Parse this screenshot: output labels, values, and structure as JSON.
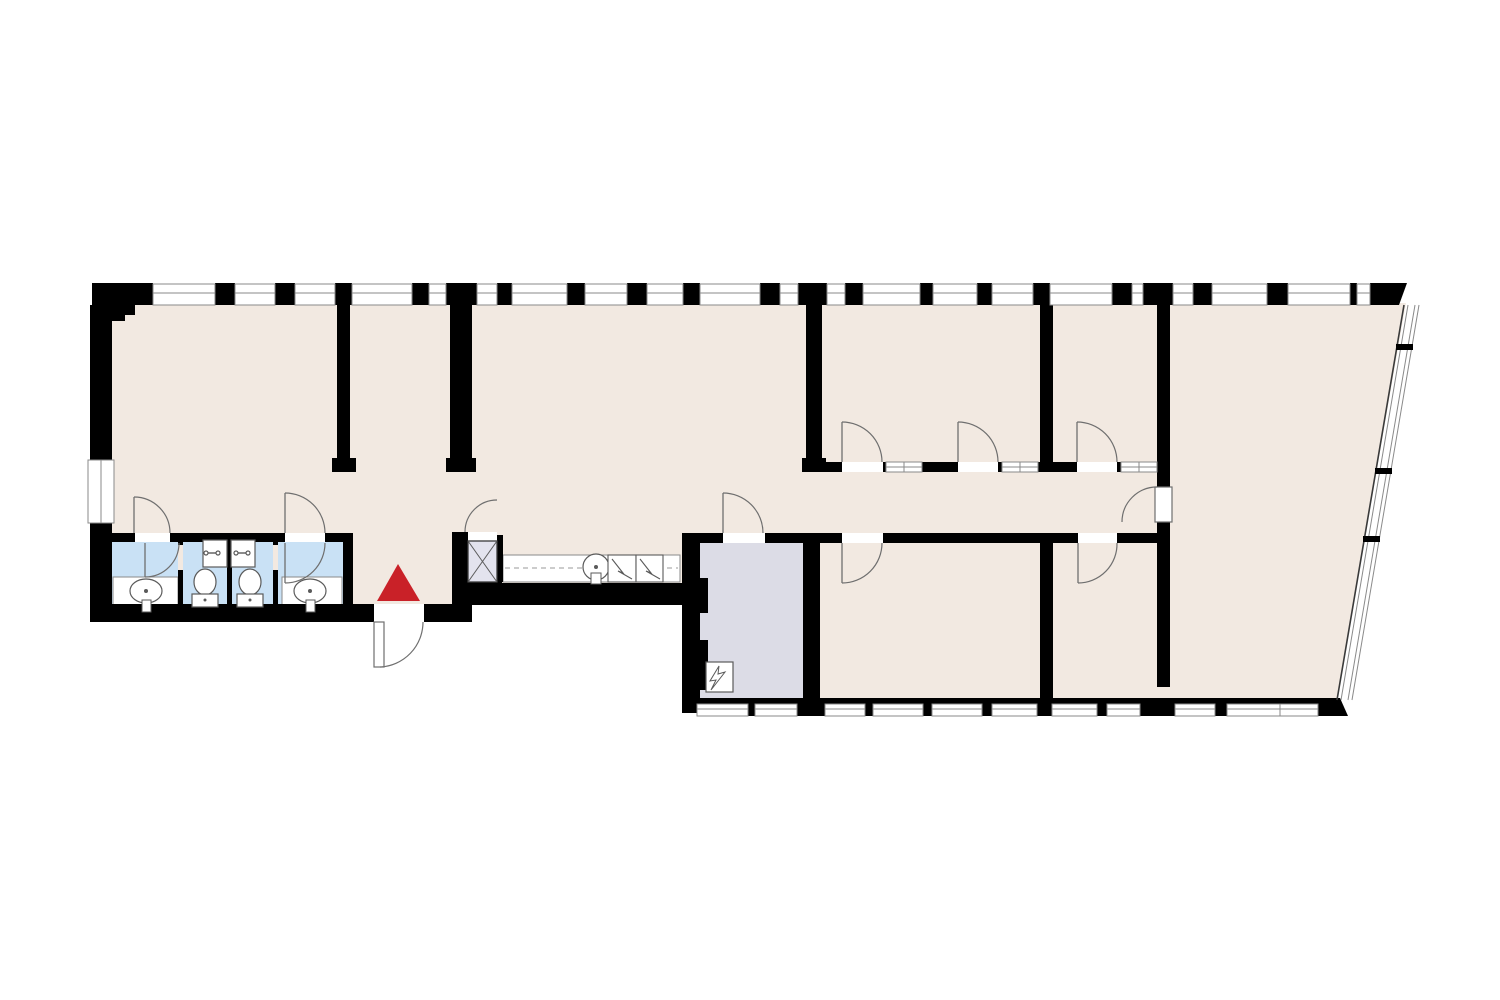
{
  "document": {
    "kind": "architectural-floor-plan",
    "visible_text": []
  },
  "canvas": {
    "width": 1500,
    "height": 1000,
    "background": "#ffffff"
  },
  "palette": {
    "floor": "#f2e9e1",
    "wall": "#000000",
    "bathroom": "#c9e1f5",
    "technical_room": "#dcdce6",
    "elevator_car": "#e3e3ee",
    "entrance_marker_red": "#c92128",
    "door_line": "#6f6f6f",
    "frame_line": "#8a8a8a",
    "fixture_line": "#5a5a5a",
    "dash_line": "#9a9a9a",
    "step_line": "#b5b5b5",
    "white": "#ffffff"
  },
  "plan": {
    "floor_polygon": [
      [
        92,
        303
      ],
      [
        1406,
        303
      ],
      [
        1336,
        703
      ],
      [
        697,
        703
      ],
      [
        697,
        590
      ],
      [
        455,
        590
      ],
      [
        455,
        614
      ],
      [
        92,
        614
      ]
    ],
    "room_fills": [
      {
        "name": "bathroom-1-floor",
        "rect": [
          112,
          542,
          66,
          63
        ],
        "color": "bathroom"
      },
      {
        "name": "wc-stall-1-floor",
        "rect": [
          183,
          542,
          44,
          63
        ],
        "color": "bathroom"
      },
      {
        "name": "wc-stall-2-floor",
        "rect": [
          232,
          542,
          41,
          63
        ],
        "color": "bathroom"
      },
      {
        "name": "bathroom-2-floor",
        "rect": [
          278,
          542,
          65,
          63
        ],
        "color": "bathroom"
      },
      {
        "name": "electrical-room-floor",
        "rect": [
          700,
          543,
          103,
          159
        ],
        "color": "technical_room"
      }
    ],
    "white_counters": [
      {
        "name": "bathroom-1-sink-counter",
        "rect": [
          113,
          577,
          65,
          30
        ]
      },
      {
        "name": "bathroom-2-sink-counter",
        "rect": [
          282,
          577,
          60,
          30
        ]
      },
      {
        "name": "kitchenette-counter",
        "rect": [
          503,
          555,
          177,
          27
        ]
      }
    ],
    "step_line": [
      92,
      620,
      377,
      620
    ],
    "wall_rects": [
      [
        92,
        305,
        43,
        10
      ],
      [
        92,
        315,
        33,
        6
      ],
      [
        90,
        305,
        22,
        155
      ],
      [
        90,
        523,
        22,
        92
      ],
      [
        90,
        604,
        368,
        18
      ],
      [
        452,
        583,
        20,
        39
      ],
      [
        458,
        583,
        226,
        22
      ],
      [
        682,
        543,
        18,
        170
      ],
      [
        700,
        578,
        8,
        35
      ],
      [
        700,
        640,
        8,
        50
      ],
      [
        803,
        543,
        17,
        157
      ],
      [
        337,
        305,
        13,
        153
      ],
      [
        332,
        458,
        24,
        14
      ],
      [
        450,
        305,
        22,
        153
      ],
      [
        446,
        458,
        30,
        14
      ],
      [
        806,
        305,
        16,
        153
      ],
      [
        802,
        458,
        24,
        14
      ],
      [
        1040,
        305,
        13,
        157
      ],
      [
        1040,
        533,
        13,
        167
      ],
      [
        1157,
        305,
        13,
        182
      ],
      [
        1157,
        522,
        13,
        165
      ],
      [
        455,
        535,
        48,
        7
      ],
      [
        452,
        532,
        16,
        50
      ],
      [
        497,
        540,
        6,
        42
      ],
      [
        452,
        580,
        50,
        25
      ],
      [
        822,
        462,
        20,
        10
      ],
      [
        883,
        462,
        3,
        10
      ],
      [
        922,
        462,
        36,
        10
      ],
      [
        998,
        462,
        4,
        10
      ],
      [
        1038,
        462,
        39,
        10
      ],
      [
        1117,
        462,
        4,
        10
      ],
      [
        682,
        533,
        41,
        10
      ],
      [
        765,
        533,
        77,
        10
      ],
      [
        883,
        533,
        195,
        10
      ],
      [
        1117,
        533,
        53,
        10
      ],
      [
        110,
        533,
        25,
        9
      ],
      [
        170,
        533,
        115,
        9
      ],
      [
        325,
        533,
        28,
        9
      ],
      [
        178,
        542,
        5,
        3
      ],
      [
        178,
        570,
        5,
        35
      ],
      [
        227,
        542,
        5,
        63
      ],
      [
        273,
        542,
        5,
        3
      ],
      [
        273,
        570,
        5,
        35
      ],
      [
        343,
        533,
        10,
        72
      ],
      [
        682,
        698,
        658,
        7
      ]
    ],
    "wall_polygons": [
      {
        "name": "top-right-corner-wedge",
        "points": [
          [
            1370,
            283
          ],
          [
            1407,
            283
          ],
          [
            1399,
            305
          ],
          [
            1370,
            305
          ]
        ]
      },
      {
        "name": "bottom-right-corner-wedge",
        "points": [
          [
            1316,
            698
          ],
          [
            1340,
            698
          ],
          [
            1348,
            716
          ],
          [
            1316,
            716
          ]
        ]
      }
    ],
    "top_facade": {
      "band_y": 283,
      "band_h": 22,
      "window_y": 284,
      "window_h": 21,
      "mid_line_y": 293,
      "piers": [
        [
          92,
          61
        ],
        [
          215,
          20
        ],
        [
          275,
          20
        ],
        [
          335,
          17
        ],
        [
          412,
          17
        ],
        [
          446,
          31
        ],
        [
          497,
          15
        ],
        [
          567,
          18
        ],
        [
          627,
          20
        ],
        [
          683,
          17
        ],
        [
          760,
          20
        ],
        [
          798,
          29
        ],
        [
          845,
          18
        ],
        [
          920,
          13
        ],
        [
          977,
          15
        ],
        [
          1033,
          17
        ],
        [
          1112,
          20
        ],
        [
          1143,
          30
        ],
        [
          1193,
          19
        ],
        [
          1267,
          21
        ],
        [
          1350,
          7
        ]
      ],
      "windows": [
        [
          153,
          62
        ],
        [
          235,
          40
        ],
        [
          295,
          40
        ],
        [
          352,
          60
        ],
        [
          429,
          17
        ],
        [
          477,
          20
        ],
        [
          512,
          55
        ],
        [
          585,
          42
        ],
        [
          647,
          36
        ],
        [
          700,
          60
        ],
        [
          780,
          18
        ],
        [
          827,
          18
        ],
        [
          863,
          57
        ],
        [
          933,
          44
        ],
        [
          992,
          41
        ],
        [
          1050,
          62
        ],
        [
          1132,
          11
        ],
        [
          1173,
          20
        ],
        [
          1212,
          55
        ],
        [
          1288,
          62
        ],
        [
          1357,
          13
        ]
      ]
    },
    "bottom_facade": {
      "window_y": 704,
      "window_h": 12,
      "mid_line_y": 709,
      "pier_y": 698,
      "pier_h": 18,
      "piers": [
        [
          748,
          7
        ],
        [
          797,
          28
        ],
        [
          865,
          8
        ],
        [
          923,
          9
        ],
        [
          982,
          10
        ],
        [
          1037,
          15
        ],
        [
          1097,
          10
        ],
        [
          1140,
          35
        ],
        [
          1215,
          12
        ]
      ],
      "windows": [
        [
          697,
          51
        ],
        [
          755,
          42
        ],
        [
          825,
          40
        ],
        [
          873,
          50
        ],
        [
          932,
          50
        ],
        [
          992,
          45
        ],
        [
          1052,
          45
        ],
        [
          1107,
          33
        ],
        [
          1175,
          40
        ],
        [
          1227,
          53
        ],
        [
          1280,
          38
        ]
      ]
    },
    "interior_windows": {
      "y": 462,
      "h": 10,
      "mid_line_y": 467,
      "segments": [
        [
          886,
          36
        ],
        [
          1002,
          36
        ],
        [
          1121,
          36
        ]
      ]
    },
    "left_wall_window": {
      "rect": [
        88,
        460,
        26,
        63
      ]
    },
    "slant_wall": {
      "inner_line": [
        1404,
        305,
        1337,
        700
      ],
      "offset_lines_dx": [
        4,
        11,
        15
      ],
      "mullions": [
        [
          1396,
          344,
          17,
          6
        ],
        [
          1375,
          468,
          17,
          6
        ],
        [
          1363,
          536,
          17,
          6
        ]
      ]
    },
    "wall_openings": [
      [
        135,
        533,
        35,
        9
      ],
      [
        285,
        533,
        40,
        9
      ],
      [
        723,
        533,
        42,
        10
      ],
      [
        842,
        533,
        41,
        10
      ],
      [
        1078,
        533,
        39,
        10
      ],
      [
        842,
        462,
        41,
        10
      ],
      [
        958,
        462,
        40,
        10
      ],
      [
        1077,
        462,
        40,
        10
      ],
      [
        374,
        604,
        50,
        18
      ],
      [
        468,
        532,
        29,
        9
      ]
    ],
    "doors": [
      {
        "name": "bathroom-1-outer-door",
        "leaf": [
          134,
          533,
          134,
          497
        ],
        "arc": "M134,497 A36,36 0 0 1 170,533"
      },
      {
        "name": "bathroom-2-outer-door",
        "leaf": [
          285,
          533,
          285,
          493
        ],
        "arc": "M285,493 A40,40 0 0 1 325,533"
      },
      {
        "name": "bathroom-1-inner-door",
        "leaf": [
          145,
          543,
          145,
          577
        ],
        "arc": "M145,577 A34,34 0 0 0 179,543"
      },
      {
        "name": "bathroom-2-inner-door",
        "leaf": [
          285,
          543,
          285,
          583
        ],
        "arc": "M285,583 A40,40 0 0 0 325,543"
      },
      {
        "name": "electrical-room-door",
        "leaf": [
          723,
          533,
          723,
          493
        ],
        "arc": "M723,493 A40,40 0 0 1 763,533"
      },
      {
        "name": "office-a-door-1",
        "leaf": [
          842,
          462,
          842,
          422
        ],
        "arc": "M842,422 A40,40 0 0 1 882,462"
      },
      {
        "name": "office-a-door-2",
        "leaf": [
          958,
          462,
          958,
          422
        ],
        "arc": "M958,422 A40,40 0 0 1 998,462"
      },
      {
        "name": "office-b-door",
        "leaf": [
          1077,
          462,
          1077,
          422
        ],
        "arc": "M1077,422 A40,40 0 0 1 1117,462"
      },
      {
        "name": "room-c-door",
        "leaf": [
          842,
          543,
          842,
          583
        ],
        "arc": "M842,583 A40,40 0 0 0 882,543"
      },
      {
        "name": "room-d-door",
        "leaf": [
          1078,
          543,
          1078,
          583
        ],
        "arc": "M1078,583 A39,39 0 0 0 1117,543"
      },
      {
        "name": "corridor-end-door",
        "leaf_rect": [
          1155,
          487,
          17,
          35
        ],
        "arc": "M1157,487 A35,35 0 0 0 1122,522"
      },
      {
        "name": "entrance-door",
        "leaf_rect": [
          374,
          622,
          10,
          45
        ],
        "arc": "M380,667 A45,45 0 0 0 423,622"
      },
      {
        "name": "elevator-door",
        "arc": "M465,532 A32,32 0 0 1 497,500"
      }
    ],
    "elevator": {
      "car_rect": [
        468,
        541,
        29,
        41
      ]
    },
    "kitchenette": {
      "dash_line": [
        505,
        568,
        678,
        568
      ],
      "sink_circle": [
        596,
        567,
        13
      ],
      "sink_dot": [
        596,
        567,
        2
      ],
      "sink_tap_rect": [
        591,
        573,
        10,
        11
      ],
      "appliance_boxes": [
        {
          "rect": [
            608,
            555,
            28,
            27
          ],
          "zigzag": [
            [
              612,
              559
            ],
            [
              623,
              573
            ],
            [
              618,
              571
            ],
            [
              632,
              579
            ]
          ]
        },
        {
          "rect": [
            636,
            555,
            27,
            27
          ],
          "zigzag": [
            [
              640,
              559
            ],
            [
              651,
              573
            ],
            [
              646,
              571
            ],
            [
              660,
              579
            ]
          ]
        }
      ]
    },
    "bath_fixtures": {
      "basins": [
        {
          "name": "bathroom-1-basin",
          "ellipse": [
            146,
            591,
            16,
            12
          ],
          "dot": [
            146,
            591,
            2
          ],
          "tap_rect": [
            142,
            600,
            9,
            12
          ]
        },
        {
          "name": "bathroom-2-basin",
          "ellipse": [
            310,
            591,
            16,
            12
          ],
          "dot": [
            310,
            591,
            2
          ],
          "tap_rect": [
            306,
            600,
            9,
            12
          ]
        }
      ],
      "wall_sinks": [
        {
          "name": "wc-1-sink",
          "rect": [
            203,
            540,
            24,
            27
          ],
          "faucet_cx": 212,
          "faucet_cy": 553
        },
        {
          "name": "wc-2-sink",
          "rect": [
            231,
            540,
            24,
            27
          ],
          "faucet_cx": 242,
          "faucet_cy": 553
        }
      ],
      "toilets": [
        {
          "name": "wc-1-toilet",
          "cistern": [
            192,
            594,
            26,
            13
          ],
          "bowl": [
            205,
            582,
            11,
            13
          ],
          "dot": [
            205,
            600,
            1.5
          ]
        },
        {
          "name": "wc-2-toilet",
          "cistern": [
            237,
            594,
            26,
            13
          ],
          "bowl": [
            250,
            582,
            11,
            13
          ],
          "dot": [
            250,
            600,
            1.5
          ]
        }
      ]
    },
    "electrical_symbol": {
      "box_rect": [
        706,
        662,
        27,
        30
      ],
      "bolt_path": "M719,666 L710,681 L716,680 L711,690 L725,672 L718,674 Z"
    },
    "entrance_marker": {
      "points": [
        [
          398,
          564
        ],
        [
          377,
          601
        ],
        [
          420,
          601
        ]
      ]
    }
  }
}
